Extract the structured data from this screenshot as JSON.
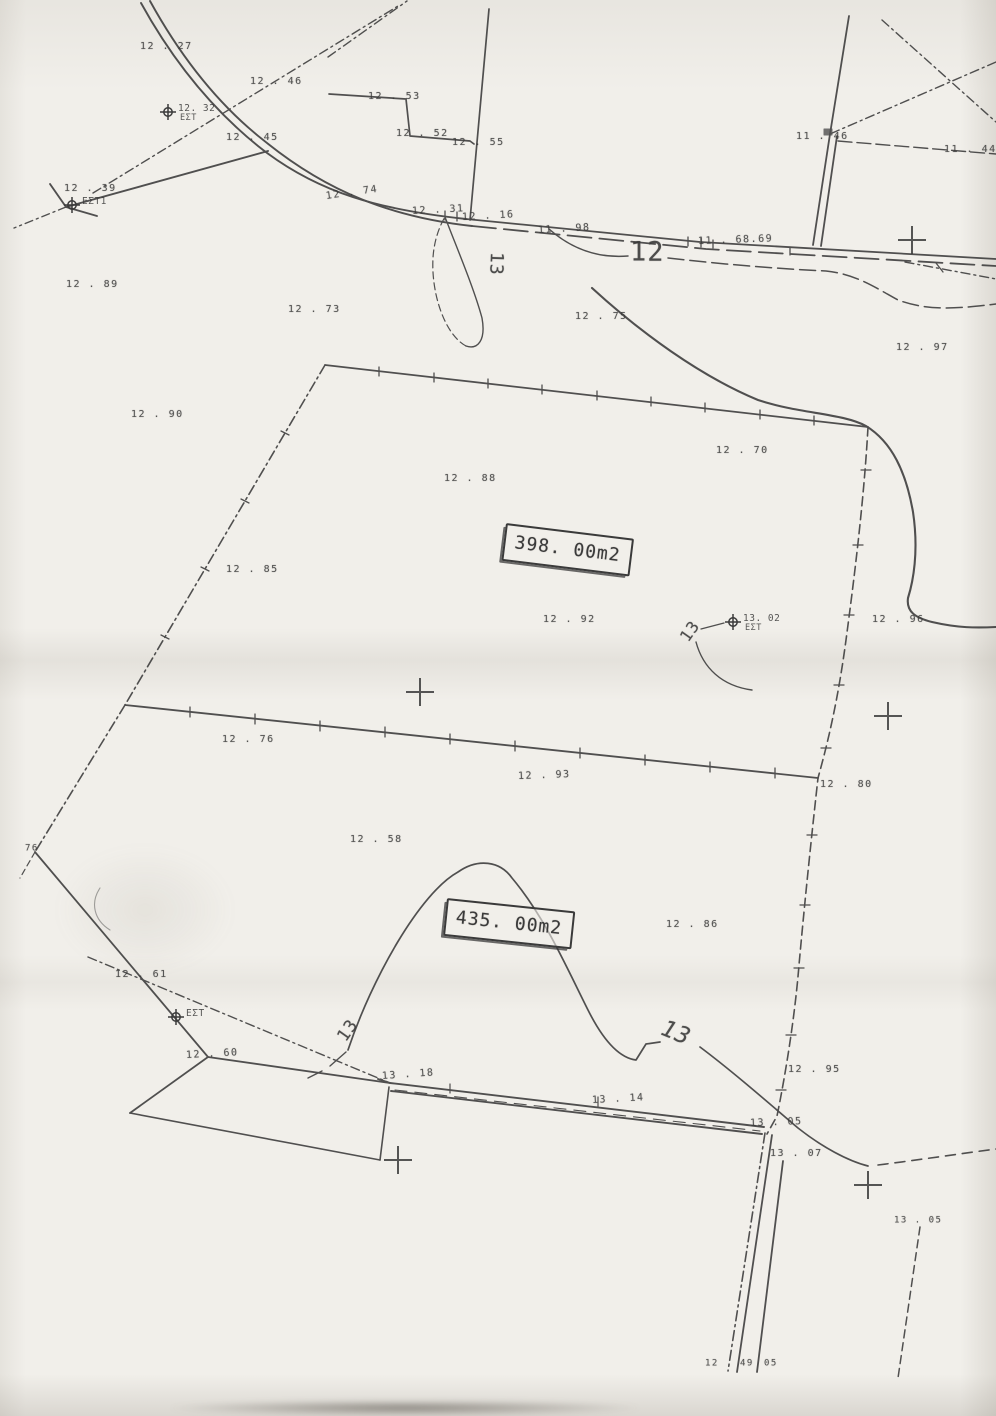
{
  "colors": {
    "paper": "#f1efea",
    "ink": "#3a3a3a"
  },
  "map": {
    "parcels": [
      {
        "area_label": "398. 00m2"
      },
      {
        "area_label": "435. 00m2"
      }
    ],
    "labels": [
      {
        "t": "12 . 27",
        "x": 140,
        "y": 47
      },
      {
        "t": "12 . 46",
        "x": 250,
        "y": 82
      },
      {
        "t": "12 . 45",
        "x": 226,
        "y": 138
      },
      {
        "t": "12 . 39",
        "x": 64,
        "y": 189
      },
      {
        "t": "12 . 53",
        "x": 368,
        "y": 97
      },
      {
        "t": "12 . 52",
        "x": 396,
        "y": 134
      },
      {
        "t": "12 . 55",
        "x": 452,
        "y": 143
      },
      {
        "t": "12 . 74",
        "x": 326,
        "y": 197,
        "r": -8
      },
      {
        "t": "12 . 31",
        "x": 412,
        "y": 212,
        "r": -3
      },
      {
        "t": "12 . 16",
        "x": 462,
        "y": 218,
        "r": -3
      },
      {
        "t": "11 . 98",
        "x": 538,
        "y": 231,
        "r": -3
      },
      {
        "t": "11 . 46",
        "x": 796,
        "y": 137
      },
      {
        "t": "11 . 44",
        "x": 944,
        "y": 150
      },
      {
        "t": "11 . 68.69",
        "x": 698,
        "y": 242,
        "r": -2
      },
      {
        "t": "12",
        "x": 630,
        "y": 252,
        "s": 27,
        "k": "contour"
      },
      {
        "t": "13",
        "x": 496,
        "y": 252,
        "s": 18,
        "r": 92,
        "k": "contour"
      },
      {
        "t": "12 . 89",
        "x": 66,
        "y": 285
      },
      {
        "t": "12 . 73",
        "x": 288,
        "y": 310
      },
      {
        "t": "12 . 75",
        "x": 575,
        "y": 317
      },
      {
        "t": "12 . 97",
        "x": 896,
        "y": 348
      },
      {
        "t": "12 . 90",
        "x": 131,
        "y": 415
      },
      {
        "t": "12 . 70",
        "x": 716,
        "y": 451
      },
      {
        "t": "12 . 88",
        "x": 444,
        "y": 479
      },
      {
        "t": "12 . 85",
        "x": 226,
        "y": 570
      },
      {
        "t": "12 . 92",
        "x": 543,
        "y": 620
      },
      {
        "t": "13",
        "x": 684,
        "y": 640,
        "s": 16,
        "r": -55,
        "k": "contour"
      },
      {
        "t": "12 . 96",
        "x": 872,
        "y": 620
      },
      {
        "t": "12 . 76",
        "x": 222,
        "y": 740
      },
      {
        "t": "12 . 93",
        "x": 518,
        "y": 777,
        "r": -2
      },
      {
        "t": "12 . 80",
        "x": 820,
        "y": 785
      },
      {
        "t": "12 . 58",
        "x": 350,
        "y": 840
      },
      {
        "t": "76",
        "x": 25,
        "y": 849,
        "s": 9
      },
      {
        "t": "12 . 86",
        "x": 666,
        "y": 925
      },
      {
        "t": "12 . 61",
        "x": 115,
        "y": 975
      },
      {
        "t": "12 . 60",
        "x": 186,
        "y": 1056,
        "r": -3
      },
      {
        "t": "13 . 18",
        "x": 382,
        "y": 1077,
        "r": -4
      },
      {
        "t": "13 . 14",
        "x": 592,
        "y": 1101,
        "r": -3
      },
      {
        "t": "13",
        "x": 342,
        "y": 1040,
        "s": 17,
        "r": -55,
        "k": "contour"
      },
      {
        "t": "13",
        "x": 662,
        "y": 1028,
        "s": 23,
        "r": 22,
        "k": "contour",
        "i": true
      },
      {
        "t": "12 . 95",
        "x": 788,
        "y": 1070
      },
      {
        "t": "13 . 05",
        "x": 750,
        "y": 1124,
        "r": -2
      },
      {
        "t": "13 . 07",
        "x": 770,
        "y": 1154
      },
      {
        "t": "13 . 05",
        "x": 894,
        "y": 1221,
        "s": 9
      },
      {
        "t": "12",
        "x": 705,
        "y": 1364,
        "s": 9
      },
      {
        "t": "49",
        "x": 740,
        "y": 1364,
        "s": 9
      },
      {
        "t": "05",
        "x": 764,
        "y": 1364,
        "s": 9
      }
    ],
    "stations": [
      {
        "x": 168,
        "y": 112,
        "l1": "12. 32",
        "l2": "ΕΣΤ"
      },
      {
        "x": 72,
        "y": 205,
        "l1": "ΕΣΤ1",
        "l2": ""
      },
      {
        "x": 733,
        "y": 622,
        "l1": "13. 02",
        "l2": "ΕΣΤ"
      },
      {
        "x": 176,
        "y": 1017,
        "l1": "ΕΣΤ",
        "l2": ""
      }
    ],
    "crosses": [
      {
        "x": 912,
        "y": 240
      },
      {
        "x": 420,
        "y": 692
      },
      {
        "x": 888,
        "y": 716
      },
      {
        "x": 398,
        "y": 1160
      },
      {
        "x": 868,
        "y": 1185
      }
    ]
  }
}
